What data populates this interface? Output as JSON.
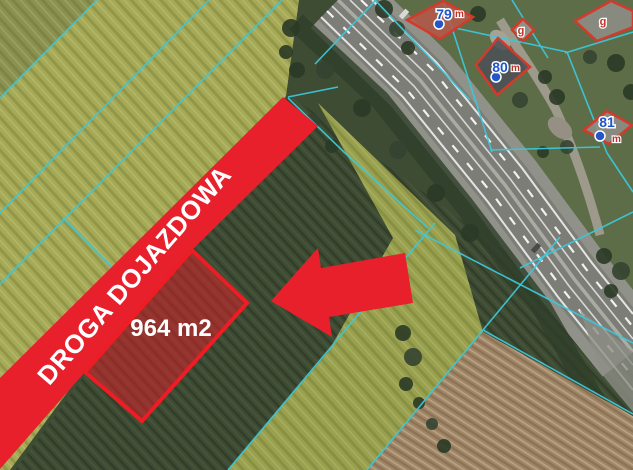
{
  "map": {
    "colors": {
      "annotation_red": "#e8202b",
      "parcel_border_red": "#ee1c25",
      "cadastral_cyan": "#3cc7da",
      "address_number_blue": "#1f55cb",
      "building_letter_red": "#b5342a",
      "building_outline_red": "#d23b2c"
    },
    "road_band": {
      "label": "DROGA DOJAZDOWA",
      "polygon": [
        [
          283,
          97
        ],
        [
          318,
          126
        ],
        [
          192,
          250
        ],
        [
          85,
          372
        ],
        [
          0,
          469
        ],
        [
          0,
          378
        ]
      ],
      "label_center": [
        141,
        281
      ],
      "label_rotation": -49
    },
    "parcel": {
      "area_label": "964 m2",
      "polygon": [
        [
          192,
          250
        ],
        [
          247,
          303
        ],
        [
          142,
          421
        ],
        [
          85,
          372
        ]
      ],
      "label_center": [
        171,
        336
      ]
    },
    "arrow": {
      "polygon": [
        [
          271,
          301
        ],
        [
          318,
          248
        ],
        [
          321,
          268
        ],
        [
          405,
          253
        ],
        [
          413,
          303
        ],
        [
          329,
          317
        ],
        [
          332,
          337
        ]
      ]
    },
    "address_markers": [
      {
        "number": "79",
        "x": 444,
        "y": 19,
        "suffix": "m",
        "sx": 455,
        "sy": 17,
        "balloon": [
          439,
          24
        ]
      },
      {
        "number": "80",
        "x": 500,
        "y": 72,
        "suffix": "m",
        "sx": 511,
        "sy": 71,
        "balloon": [
          496,
          77
        ]
      },
      {
        "number": "81",
        "x": 607,
        "y": 127,
        "suffix": "m",
        "sx": 612,
        "sy": 142,
        "balloon": [
          600,
          136
        ]
      }
    ],
    "building_labels": [
      {
        "label": "g",
        "x": 521,
        "y": 34
      },
      {
        "label": "g",
        "x": 603,
        "y": 25
      }
    ],
    "buildings": [
      {
        "polygon": [
          [
            407,
            20
          ],
          [
            443,
            1
          ],
          [
            473,
            17
          ],
          [
            440,
            39
          ]
        ],
        "fill": "#b45a4a"
      },
      {
        "polygon": [
          [
            498,
            38
          ],
          [
            530,
            67
          ],
          [
            497,
            95
          ],
          [
            476,
            65
          ]
        ],
        "fill": "#4c5055"
      },
      {
        "polygon": [
          [
            584,
            130
          ],
          [
            607,
            111
          ],
          [
            632,
            125
          ],
          [
            609,
            144
          ]
        ],
        "fill": "#8e8e88"
      },
      {
        "polygon": [
          [
            512,
            30
          ],
          [
            523,
            19
          ],
          [
            534,
            30
          ],
          [
            523,
            41
          ]
        ],
        "fill": "#9a958d"
      },
      {
        "polygon": [
          [
            575,
            21
          ],
          [
            611,
            1
          ],
          [
            633,
            11
          ],
          [
            633,
            27
          ],
          [
            597,
            41
          ]
        ],
        "fill": "#8e8e88"
      }
    ],
    "cadastral_lines": [
      [
        97,
        0,
        0,
        98
      ],
      [
        209,
        0,
        0,
        213
      ],
      [
        282,
        0,
        0,
        284
      ],
      [
        63,
        218,
        125,
        280
      ],
      [
        338,
        87,
        288,
        97
      ],
      [
        288,
        98,
        345,
        153
      ],
      [
        345,
        153,
        428,
        228
      ],
      [
        435,
        223,
        228,
        470
      ],
      [
        415,
        230,
        633,
        343
      ],
      [
        375,
        0,
        470,
        100
      ],
      [
        376,
        0,
        315,
        64
      ],
      [
        443,
        0,
        492,
        152
      ],
      [
        455,
        28,
        567,
        52
      ],
      [
        512,
        0,
        548,
        58
      ],
      [
        567,
        52,
        607,
        153
      ],
      [
        565,
        53,
        633,
        32
      ],
      [
        490,
        150,
        600,
        147
      ],
      [
        607,
        153,
        633,
        192
      ],
      [
        483,
        330,
        367,
        470
      ],
      [
        483,
        330,
        633,
        414
      ],
      [
        483,
        330,
        560,
        237
      ],
      [
        520,
        268,
        633,
        212
      ]
    ]
  }
}
